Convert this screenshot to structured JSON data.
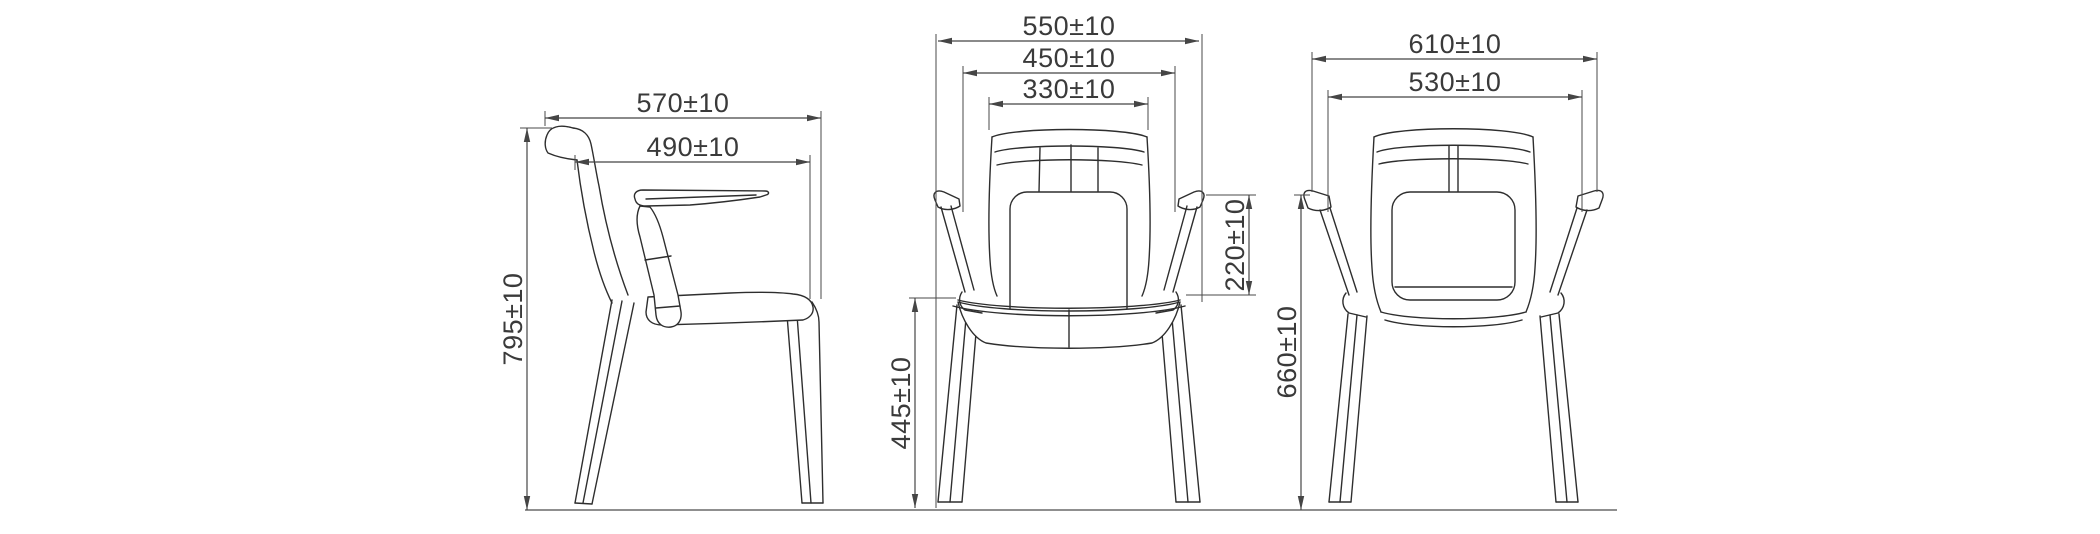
{
  "drawing": {
    "kind": "furniture dimension drawing",
    "subject": "armchair shown in three orthographic views (side, front, back)",
    "views": [
      "side",
      "front",
      "back"
    ]
  },
  "dims": {
    "d570": {
      "label": "570±10",
      "value": 570,
      "tolerance": 10,
      "axis": "horizontal",
      "view": "side"
    },
    "d490": {
      "label": "490±10",
      "value": 490,
      "tolerance": 10,
      "axis": "horizontal",
      "view": "side"
    },
    "d795": {
      "label": "795±10",
      "value": 795,
      "tolerance": 10,
      "axis": "vertical",
      "view": "side"
    },
    "d550": {
      "label": "550±10",
      "value": 550,
      "tolerance": 10,
      "axis": "horizontal",
      "view": "front"
    },
    "d450": {
      "label": "450±10",
      "value": 450,
      "tolerance": 10,
      "axis": "horizontal",
      "view": "front"
    },
    "d330": {
      "label": "330±10",
      "value": 330,
      "tolerance": 10,
      "axis": "horizontal",
      "view": "front"
    },
    "d445": {
      "label": "445±10",
      "value": 445,
      "tolerance": 10,
      "axis": "vertical",
      "view": "front"
    },
    "d220": {
      "label": "220±10",
      "value": 220,
      "tolerance": 10,
      "axis": "vertical",
      "view": "front"
    },
    "d610": {
      "label": "610±10",
      "value": 610,
      "tolerance": 10,
      "axis": "horizontal",
      "view": "back"
    },
    "d530": {
      "label": "530±10",
      "value": 530,
      "tolerance": 10,
      "axis": "horizontal",
      "view": "back"
    },
    "d660": {
      "label": "660±10",
      "value": 660,
      "tolerance": 10,
      "axis": "vertical",
      "view": "back"
    }
  },
  "colors": {
    "chair_line": "#2e2e2e",
    "dimension_line": "#454545",
    "dimension_text": "#3a3a3a",
    "ground_line": "#8f8f8f",
    "background": "#ffffff"
  }
}
